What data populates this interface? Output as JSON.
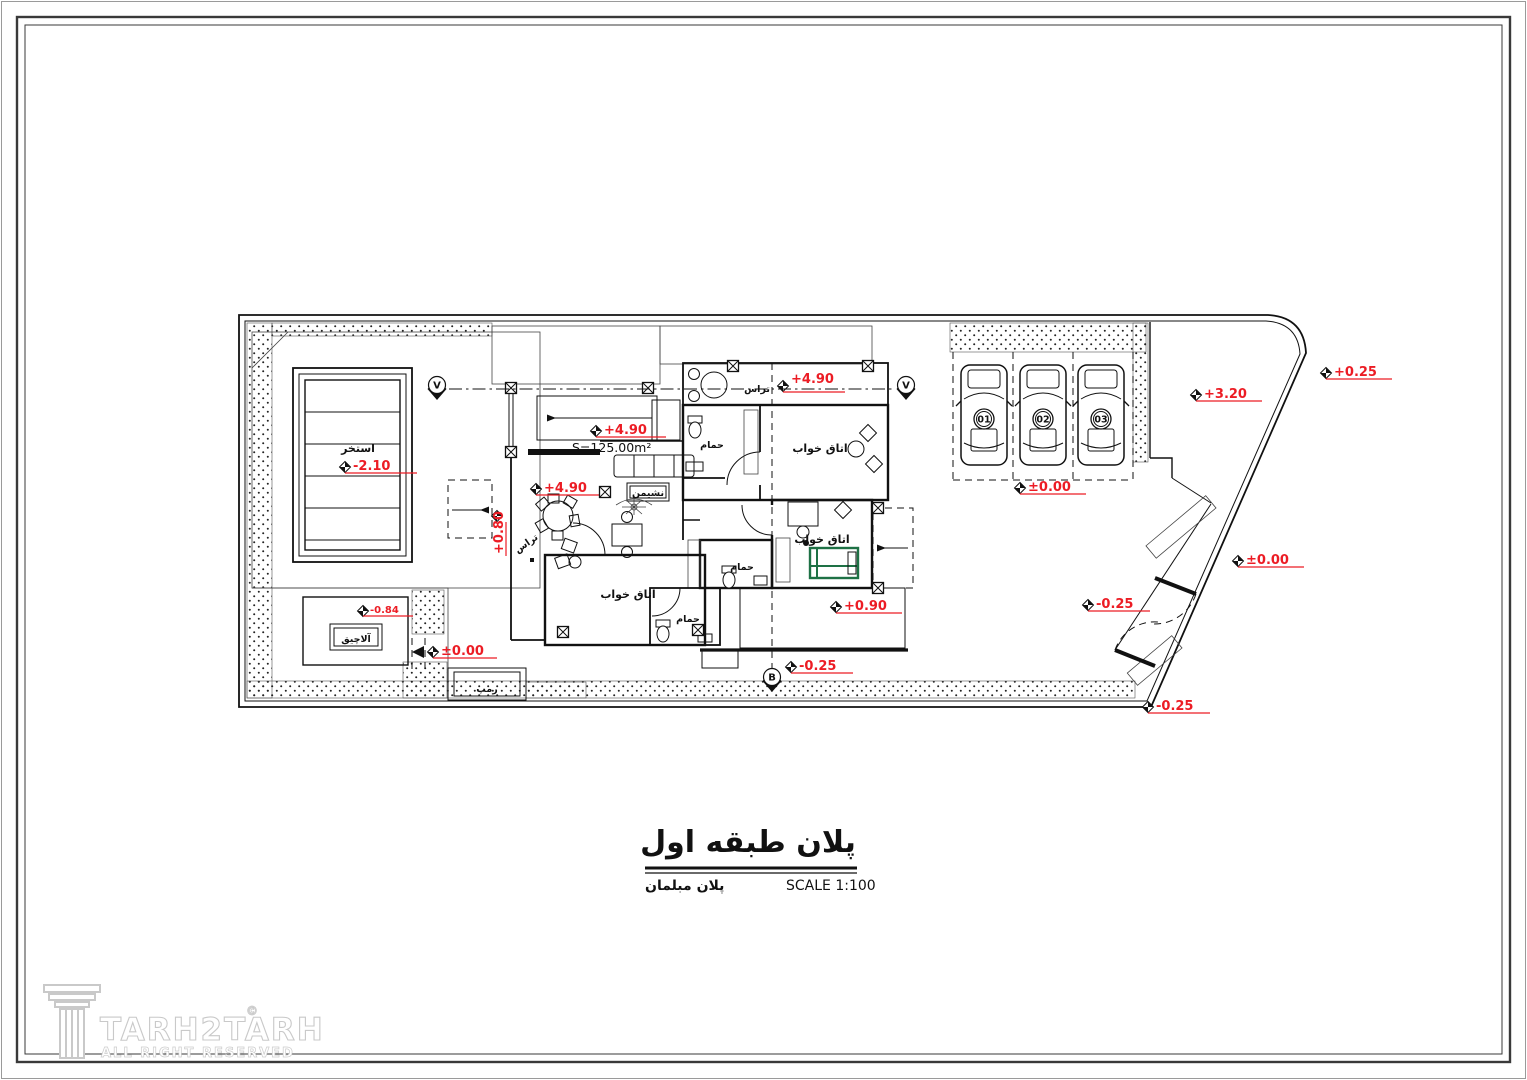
{
  "drawing": {
    "title": "پلان طبقه اول",
    "subtitle_left": "پلان مبلمان",
    "scale_label": "SCALE 1:100",
    "area_label": "S=125.00m²"
  },
  "logo": {
    "brand": "TARH2TARH",
    "copyright_symbol": "©",
    "tagline": "ALL RIGHT RESERVED"
  },
  "rooms": {
    "pool": "استخر",
    "gazebo": "آلاچیق",
    "terrace_roof": "تراس",
    "terrace_side": "تراس",
    "living_room": "نشیمن",
    "bedroom_top": "اتاق خواب",
    "bedroom_middle": "اتاق خواب",
    "bedroom_bottom": "اتاق خواب",
    "bath_top": "حمام",
    "bath_middle": "حمام",
    "bath_bottom": "حمام",
    "ramp": "رمپ"
  },
  "levels": {
    "pool": "-2.10",
    "gazebo": "-0.84",
    "court_entry": "±0.00",
    "side_stairs": "+0.80",
    "dining_terrace": "+4.90",
    "living": "+4.90",
    "roof_terrace": "+4.90",
    "patio": "+0.90",
    "south_yard": "-0.25",
    "parking": "±0.00",
    "east_yard": "+3.20",
    "street_corner": "+0.25",
    "entry_east": "±0.00",
    "entry_mid": "-0.25",
    "entry_south": "-0.25"
  },
  "section_markers": {
    "top_left": "V",
    "top_right": "V",
    "bottom": "B"
  },
  "parking": {
    "car_numbers": [
      "01",
      "02",
      "03"
    ]
  },
  "colors": {
    "annotation_red": "#ec1c24",
    "bed_green": "#1e7145",
    "line_black": "#111111",
    "paper_white": "#ffffff"
  }
}
